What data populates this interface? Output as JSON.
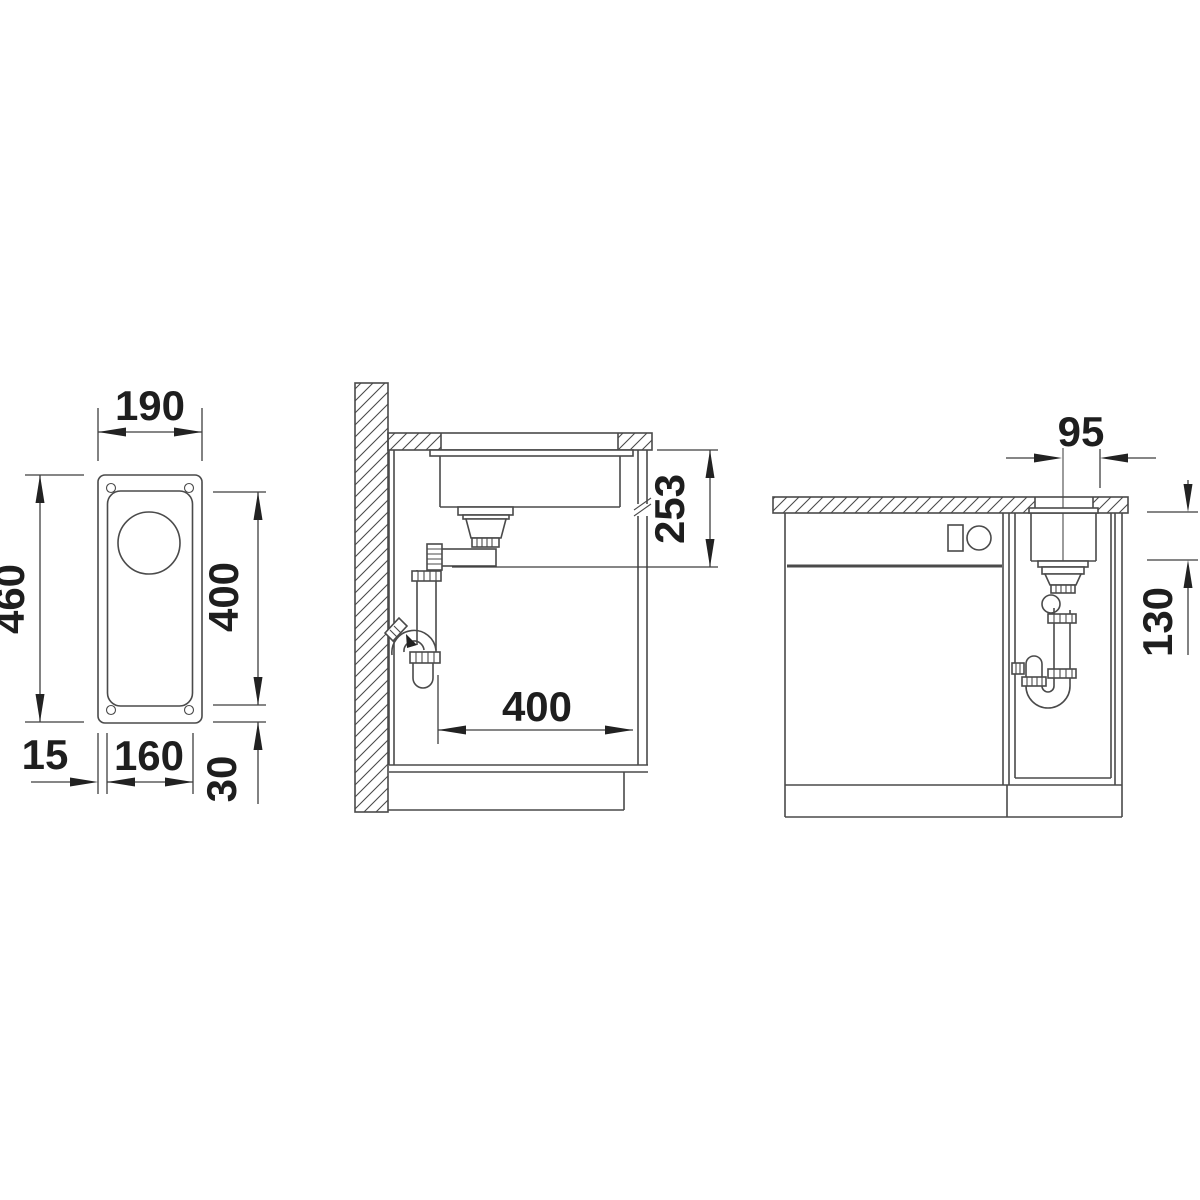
{
  "page": {
    "background": "#ffffff"
  },
  "drawing": {
    "line_color": "#4a4a4a",
    "text_color": "#1e1e1e",
    "views": {
      "top": {
        "label": "top-view",
        "dims": {
          "overall_width": "190",
          "overall_length": "460",
          "bowl_length": "400",
          "rim_left": "15",
          "bowl_width": "160",
          "rim_bottom": "30"
        }
      },
      "side": {
        "label": "side-section-view",
        "dims": {
          "drain_height_below_top": "253",
          "cabinet_inner_width": "400"
        }
      },
      "front": {
        "label": "front-view",
        "dims": {
          "drain_center_to_edge": "95",
          "bowl_depth": "130"
        }
      }
    }
  }
}
